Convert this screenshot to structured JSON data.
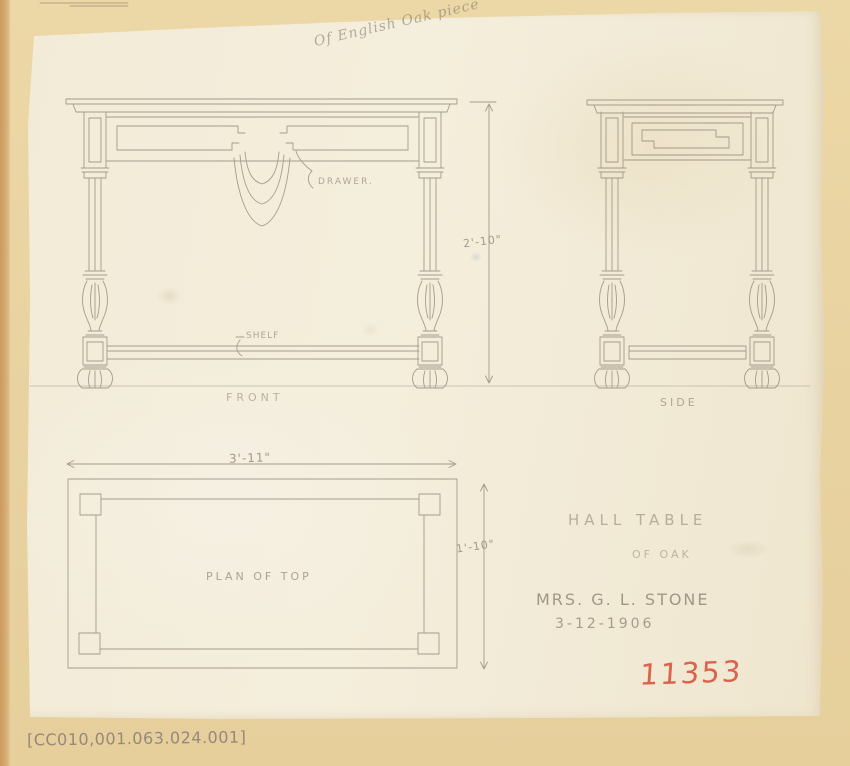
{
  "document": {
    "annotation_top": "Of English Oak piece",
    "catalog_number": "[CC010,001.063.024.001]",
    "accession_number": "11353"
  },
  "views": {
    "front": {
      "label": "FRONT"
    },
    "side": {
      "label": "SIDE"
    },
    "plan": {
      "label": "PLAN OF TOP"
    }
  },
  "callouts": {
    "drawer": "DRAWER.",
    "shelf": "SHELF"
  },
  "dimensions": {
    "height": "2'-10\"",
    "width": "3'-11\"",
    "depth": "1'-10\""
  },
  "title_block": {
    "title": "HALL TABLE",
    "material": "OF OAK",
    "client": "MRS. G. L. STONE",
    "date": "3-12-1906"
  },
  "colors": {
    "album_page": "#e8d2a0",
    "paper": "#f3ecd9",
    "pencil_line": "#7d7264",
    "pencil_text": "#95887a",
    "accession_red": "#d95740"
  }
}
